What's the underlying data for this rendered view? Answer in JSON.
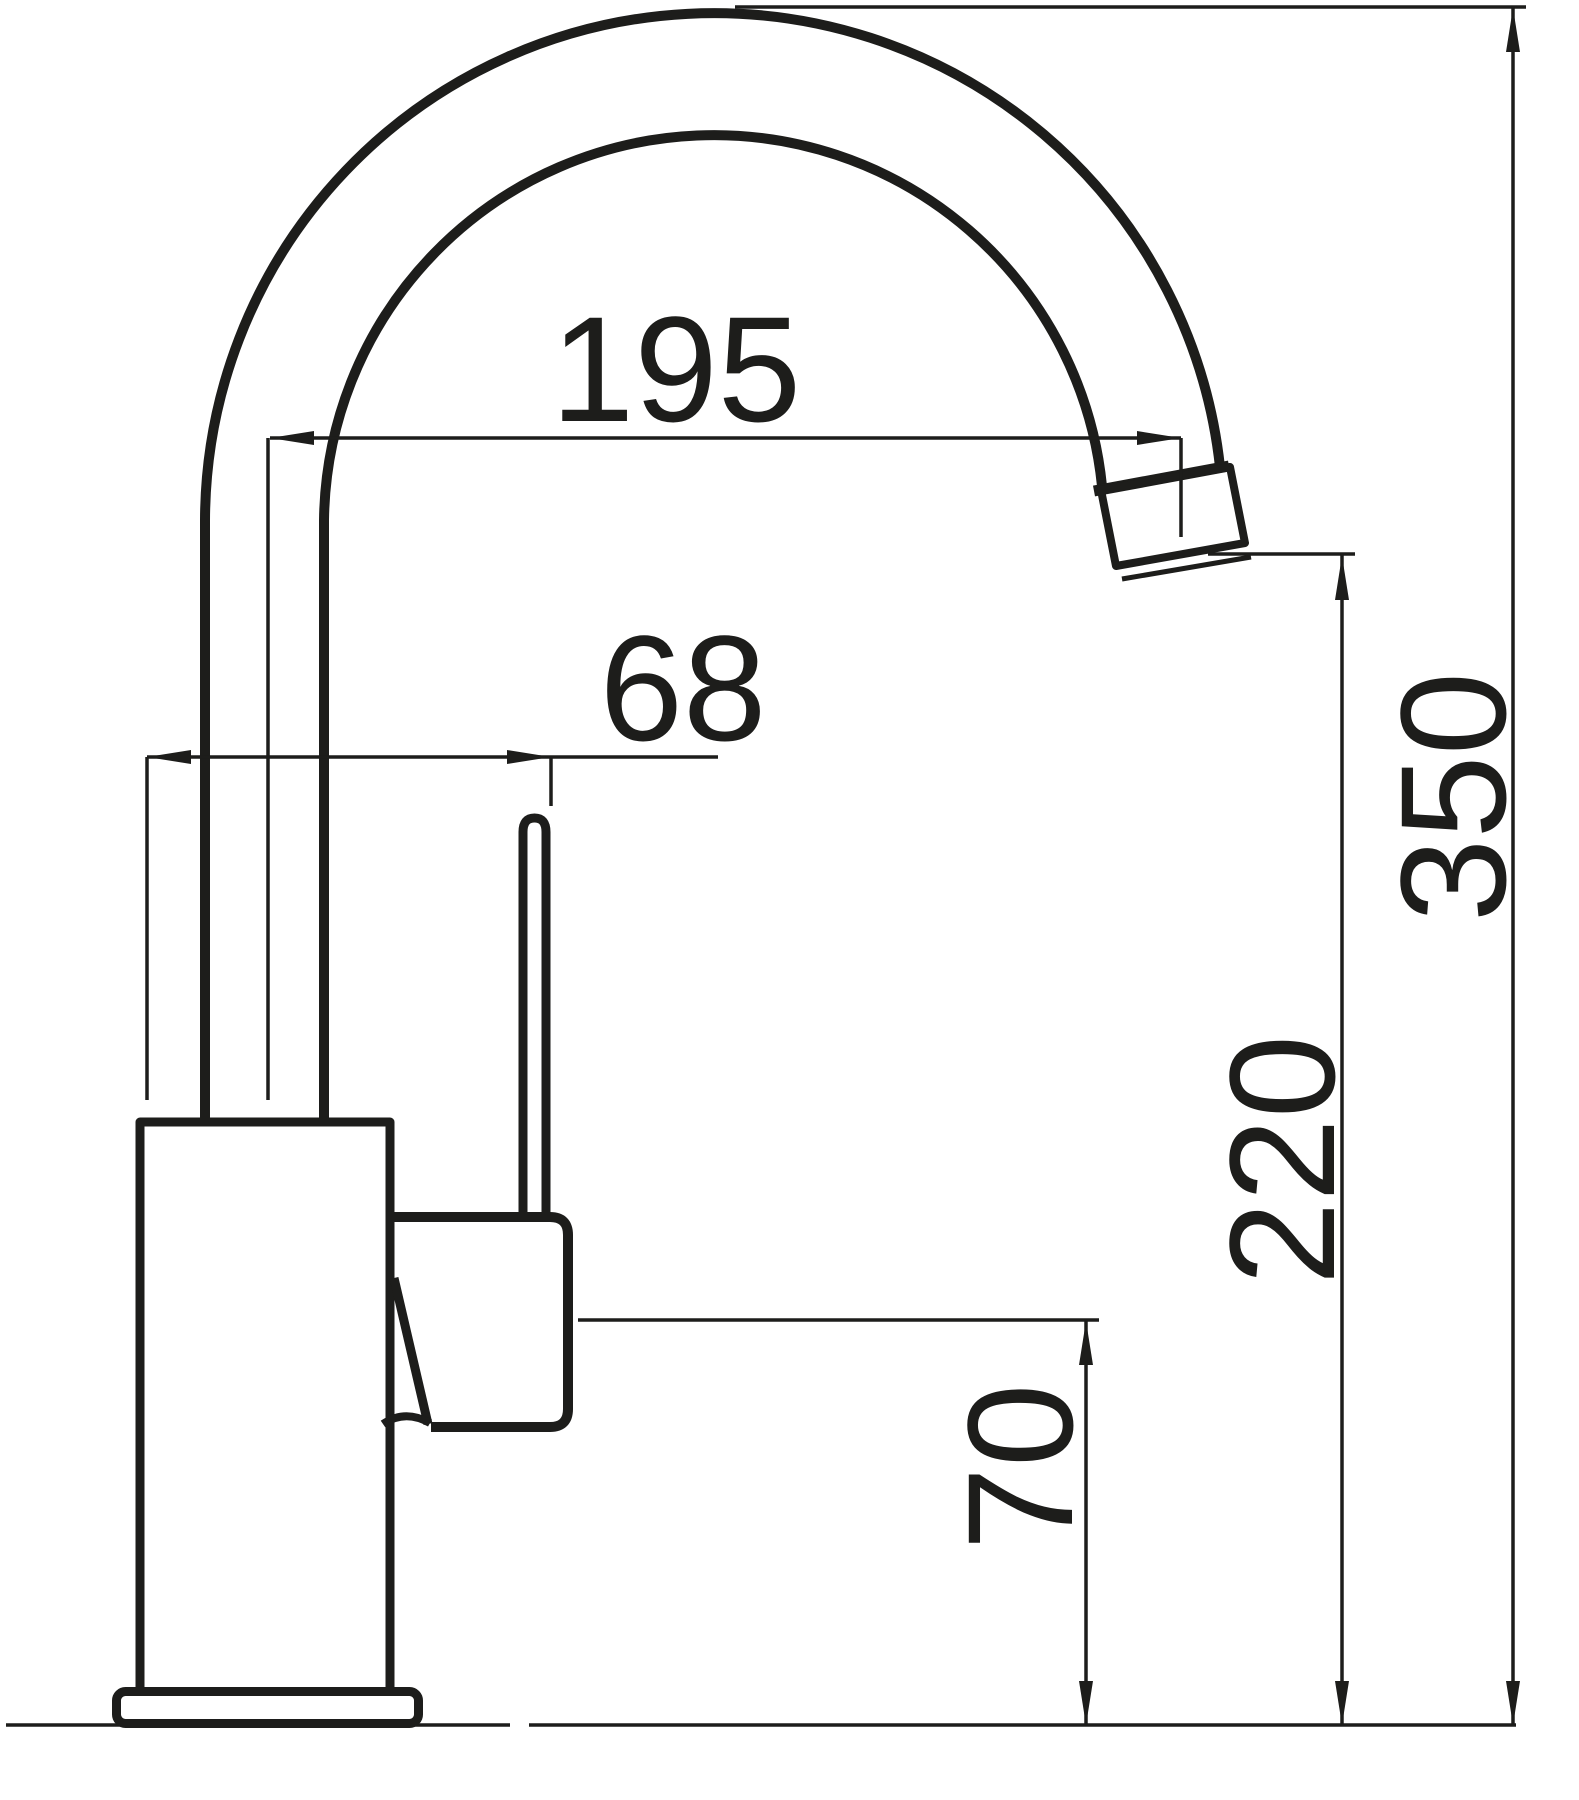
{
  "drawing": {
    "background_color": "#ffffff",
    "ink_color": "#1d1d1b",
    "dimensions": [
      {
        "id": "spout-reach",
        "value": "195",
        "orientation": "horizontal"
      },
      {
        "id": "handle-offset",
        "value": "68",
        "orientation": "horizontal"
      },
      {
        "id": "overall-height",
        "value": "350",
        "orientation": "vertical"
      },
      {
        "id": "spout-outlet-height",
        "value": "220",
        "orientation": "vertical"
      },
      {
        "id": "handle-pivot-height",
        "value": "70",
        "orientation": "vertical"
      }
    ],
    "parts": [
      "gooseneck-spout",
      "riser-pipe",
      "aerator-outlet",
      "mixer-body",
      "base-flange",
      "handle-lever-rod",
      "handle-cartridge-housing",
      "counter-reference-line"
    ]
  }
}
